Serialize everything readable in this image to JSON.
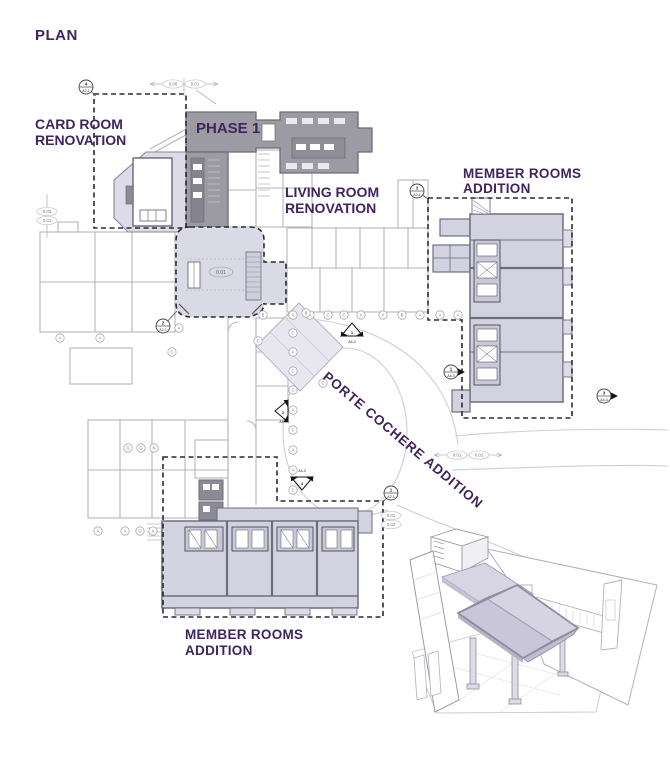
{
  "title": "PLAN",
  "annotations": {
    "card_room_line1": "CARD ROOM",
    "card_room_line2": "RENOVATION",
    "phase": "PHASE 1",
    "living_line1": "LIVING ROOM",
    "living_line2": "RENOVATION",
    "member_tr_line1": "MEMBER ROOMS",
    "member_tr_line2": "ADDITION",
    "porte": "PORTE COCHERE ADDITION",
    "member_b_line1": "MEMBER ROOMS",
    "member_b_line2": "ADDITION"
  },
  "room_tag": "0.01",
  "colors": {
    "purple_text": "#40245e",
    "phase_gray": "#9c9ba3",
    "lavender_fill": "#d6d5e3",
    "lavender_light": "#dcdbe7",
    "wall_dark": "#6f6e7d",
    "line_gray": "#b6b5bd",
    "dash_dark": "#2b2933"
  },
  "dims": [
    {
      "labels": [
        "0.00",
        "0.01"
      ],
      "x": 184,
      "y": 84,
      "layout": "h"
    },
    {
      "labels": [
        "0.03",
        "0.01"
      ],
      "x": 47,
      "y": 216,
      "layout": "v",
      "line": "v"
    },
    {
      "labels": [
        "0.01",
        "0.02"
      ],
      "x": 468,
      "y": 455,
      "layout": "h"
    },
    {
      "labels": [
        "0.01",
        "0.02"
      ],
      "x": 391,
      "y": 520,
      "layout": "v"
    }
  ],
  "callouts": [
    {
      "num": "4",
      "sheet": "A2-1",
      "x": 86,
      "y": 87,
      "lx": 96,
      "ly": 96
    },
    {
      "num": "3",
      "sheet": "A2-1",
      "x": 417,
      "y": 191,
      "lx": 428,
      "ly": 199
    },
    {
      "num": "2",
      "sheet": "A2-1",
      "x": 163,
      "y": 326,
      "lx": 177,
      "ly": 311
    },
    {
      "num": "1",
      "sheet": "A2-1",
      "x": 391,
      "y": 493,
      "lx": 383,
      "ly": 502
    }
  ],
  "elev_markers": [
    {
      "num": "1",
      "sheet": "A4-3",
      "x": 352,
      "y": 331,
      "dir": "up",
      "style": "tri"
    },
    {
      "num": "2",
      "sheet": "A4-3",
      "x": 283,
      "y": 411,
      "dir": "left",
      "style": "tri"
    },
    {
      "num": "4",
      "sheet": "A4-3",
      "x": 302,
      "y": 482,
      "dir": "down",
      "style": "tri"
    },
    {
      "num": "3",
      "sheet": "A4-3",
      "x": 604,
      "y": 396,
      "dir": "right",
      "style": "circle"
    },
    {
      "num": "1",
      "sheet": "A4-3",
      "x": 451,
      "y": 372,
      "dir": "right",
      "style": "circle"
    }
  ],
  "grid_bubbles": [
    {
      "l": "B",
      "x": 263,
      "y": 315
    },
    {
      "l": "A",
      "x": 293,
      "y": 315
    },
    {
      "l": "A",
      "x": 310,
      "y": 315
    },
    {
      "l": "C",
      "x": 328,
      "y": 315
    },
    {
      "l": "C",
      "x": 344,
      "y": 315
    },
    {
      "l": "A",
      "x": 361,
      "y": 315
    },
    {
      "l": "A",
      "x": 383,
      "y": 315
    },
    {
      "l": "B",
      "x": 402,
      "y": 315
    },
    {
      "l": "A",
      "x": 420,
      "y": 315
    },
    {
      "l": "A",
      "x": 440,
      "y": 315
    },
    {
      "l": "A",
      "x": 458,
      "y": 315
    },
    {
      "l": "C",
      "x": 293,
      "y": 333
    },
    {
      "l": "A",
      "x": 293,
      "y": 352
    },
    {
      "l": "C",
      "x": 293,
      "y": 371
    },
    {
      "l": "C",
      "x": 293,
      "y": 390
    },
    {
      "l": "A",
      "x": 293,
      "y": 410
    },
    {
      "l": "C",
      "x": 293,
      "y": 430
    },
    {
      "l": "A",
      "x": 293,
      "y": 450
    },
    {
      "l": "A",
      "x": 293,
      "y": 470
    },
    {
      "l": "C",
      "x": 293,
      "y": 490
    },
    {
      "l": "A",
      "x": 98,
      "y": 531
    },
    {
      "l": "A",
      "x": 125,
      "y": 531
    },
    {
      "l": "G",
      "x": 140,
      "y": 531
    },
    {
      "l": "A",
      "x": 153,
      "y": 531
    },
    {
      "l": "G",
      "x": 128,
      "y": 448
    },
    {
      "l": "G",
      "x": 141,
      "y": 448
    },
    {
      "l": "N",
      "x": 154,
      "y": 448
    },
    {
      "l": "A",
      "x": 179,
      "y": 328
    },
    {
      "l": "C",
      "x": 172,
      "y": 352
    },
    {
      "l": "C",
      "x": 258,
      "y": 341
    },
    {
      "l": "B",
      "x": 306,
      "y": 313
    },
    {
      "l": "C",
      "x": 323,
      "y": 383
    },
    {
      "l": "A",
      "x": 60,
      "y": 338
    },
    {
      "l": "A",
      "x": 100,
      "y": 338
    }
  ]
}
